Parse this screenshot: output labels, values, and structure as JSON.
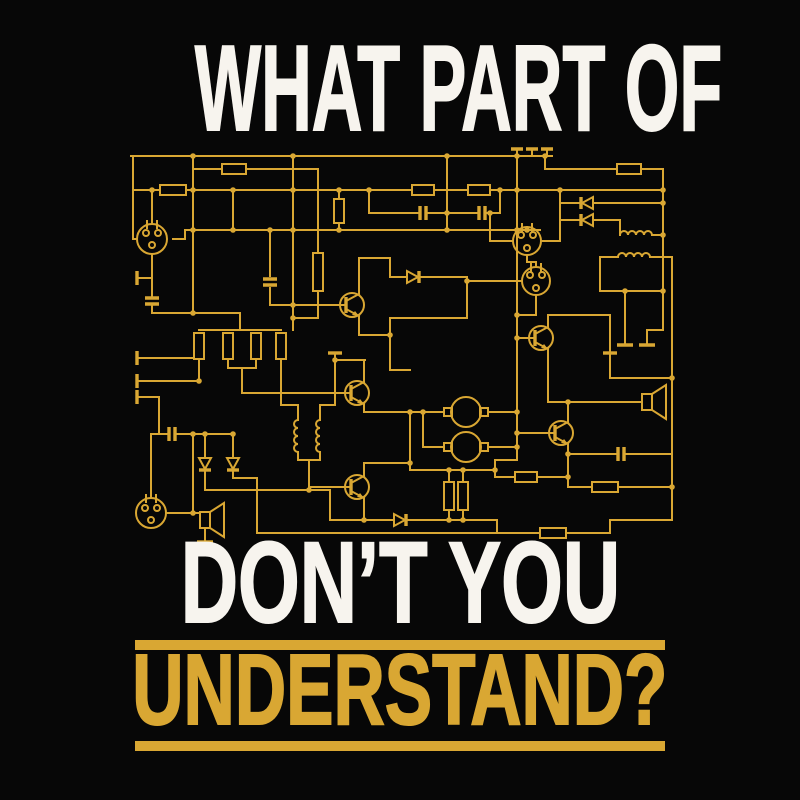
{
  "colors": {
    "background": "#070707",
    "gold": "#D9A733",
    "white": "#F7F4EE"
  },
  "headline": {
    "line1": "WHAT PART OF",
    "line2": "DON’T YOU",
    "line3": "UNDERSTAND?"
  },
  "schematic": {
    "name": "electronic-circuit-schematic",
    "style": "vintage gold schematic line-art on black",
    "line_color": "#D9A733",
    "components": {
      "vacuum_tubes": 4,
      "transistors": 5,
      "resistors": 16,
      "capacitors": 6,
      "diodes": 6,
      "inductor_coils": 4,
      "speakers": 2,
      "motor_circles": 2,
      "ground_contacts": 12,
      "junction_dots": 58
    }
  }
}
